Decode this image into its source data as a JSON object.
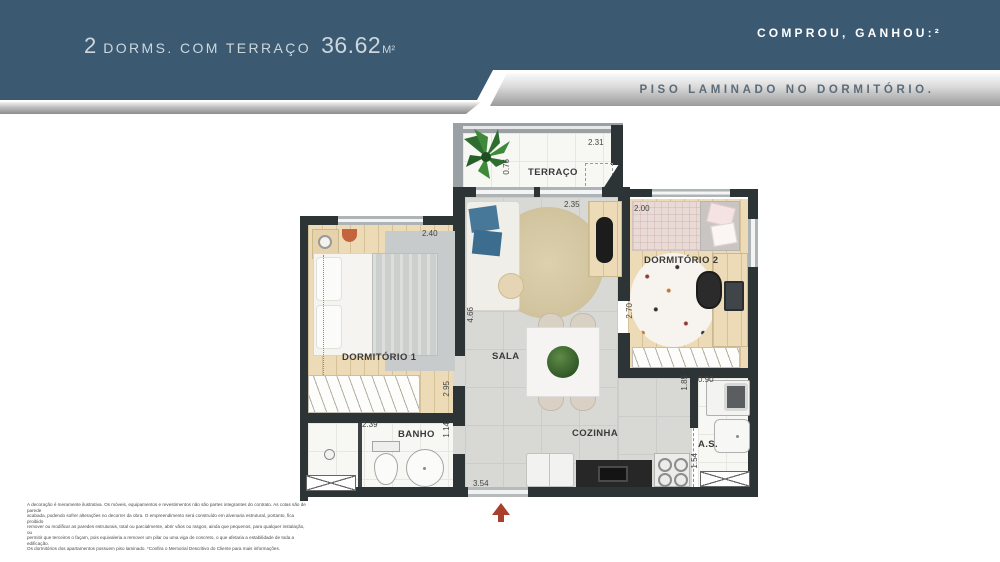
{
  "header": {
    "title_prefix": "2",
    "title_main": "DORMS. COM TERRAÇO",
    "area_value": "36.62",
    "area_unit": "M²",
    "promo_heading": "COMPROU, GANHOU:²",
    "promo_detail": "PISO LAMINADO NO DORMITÓRIO."
  },
  "floorplan": {
    "rooms": {
      "terraco": {
        "label": "TERRAÇO",
        "dim_width": "2.31",
        "dim_depth": "0.76"
      },
      "dormitorio1": {
        "label": "DORMITÓRIO 1",
        "dim_width": "2.40",
        "dim_depth": "2.95"
      },
      "sala": {
        "label": "SALA",
        "dim_width": "2.35",
        "dim_depth": "4.66"
      },
      "dormitorio2": {
        "label": "DORMITÓRIO 2",
        "dim_width": "2.00",
        "dim_depth": "2.70"
      },
      "banho": {
        "label": "BANHO",
        "dim_width": "2.39",
        "dim_depth": "1.14"
      },
      "cozinha": {
        "label": "COZINHA",
        "dim_width": "3.54"
      },
      "area_servico": {
        "label": "A.S.",
        "dim_width": "0.90",
        "dim_depth_upper": "1.85",
        "dim_depth_lower": "1.54"
      }
    },
    "colors": {
      "wall": "#2d3436",
      "terrace_wall": "#9aa0a4",
      "banner_blue": "#3b5971",
      "north_arrow": "#a8402b"
    }
  },
  "disclaimer": {
    "lines": [
      "A decoração é meramente ilustrativa. Os móveis, equipamentos e revestimentos não são partes integrantes do contrato. As cotas são de parede",
      "acabada, podendo sofrer alterações no decorrer da obra. O empreendimento será construído em alvenaria estrutural, portanto, fica proibido",
      "remover ou modificar as paredes estruturais, total ou parcialmente, abrir vãos ou rasgos, ainda que pequenos, para qualquer instalação, ou",
      "permitir que terceiros o façam, pois equivaleria a remover um pilar ou uma viga de concreto, o que afetaria a estabilidade de toda a edificação.",
      "Os dormitórios dos apartamentos possuem piso laminado. *Confira o Memorial Descritivo do Cliente para mais informações."
    ]
  }
}
